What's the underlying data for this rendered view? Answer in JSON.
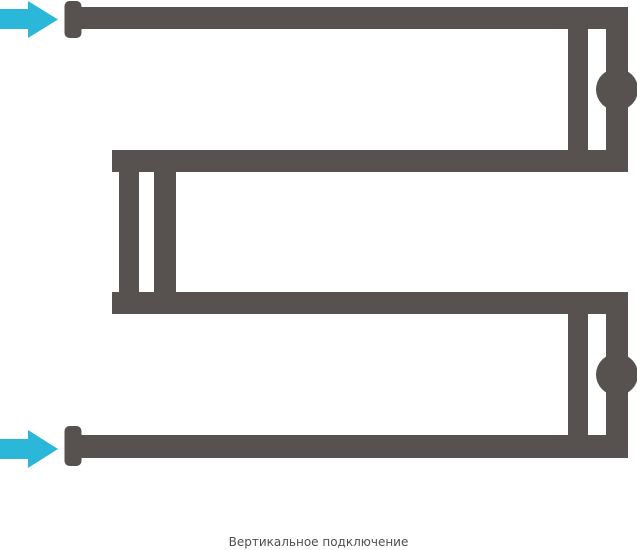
{
  "caption": {
    "text": "Вертикальное подключение"
  },
  "colors": {
    "pipe": "#575250",
    "flow_arrow": "#2ab7d9",
    "background": "#ffffff",
    "caption_text": "#4f4f4f"
  },
  "icons": {
    "flow_arrow_top": "right-arrow",
    "flow_arrow_bottom": "right-arrow",
    "valve_top": "ball-valve",
    "valve_bottom": "ball-valve"
  }
}
